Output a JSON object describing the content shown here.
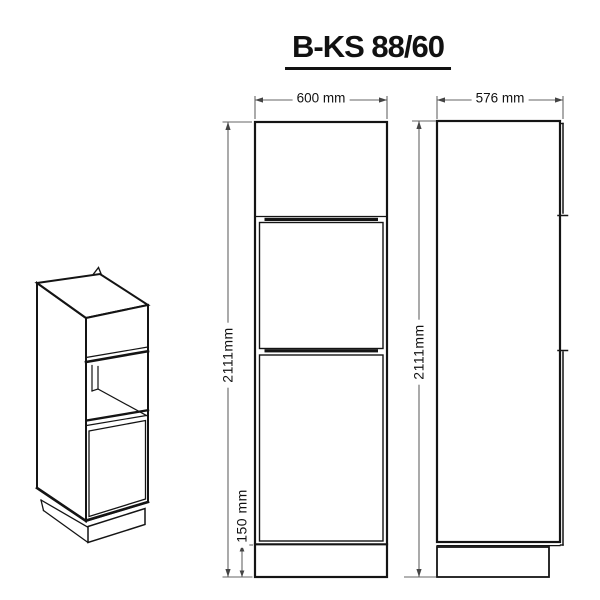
{
  "title": "B-KS 88/60",
  "front_view": {
    "width_label": "600 mm",
    "height_label": "2111mm",
    "plinth_height_label": "150 mm"
  },
  "side_view": {
    "width_label": "576 mm",
    "height_label": "2111mm"
  },
  "colors": {
    "line": "#141414",
    "dimension_line": "#666666",
    "background": "#ffffff"
  }
}
